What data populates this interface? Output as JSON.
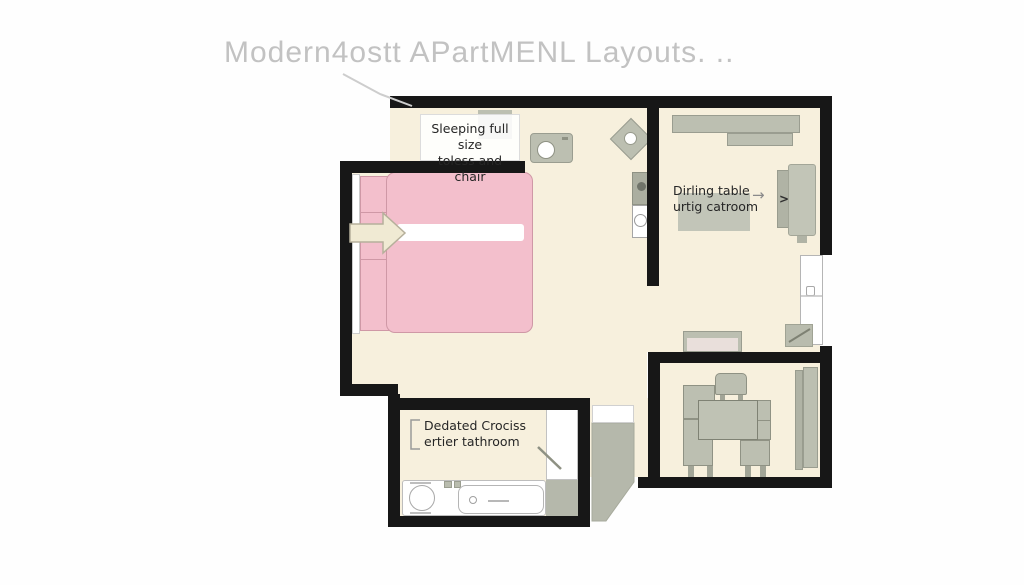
{
  "title": "Modern4ostt APartMENL Layouts. ..",
  "plan": {
    "sleeping_label": {
      "line1": "Sleeping full size",
      "line2": "toless and chair"
    },
    "dining_label": {
      "line1": "Dirling table",
      "line2": "urtig catroom"
    },
    "bathroom_label": {
      "line1": "Dedated Crociss",
      "line2": "ertier tathroom"
    },
    "dining_arrow_glyph": "→",
    "armchair_glyph": ">"
  },
  "colors": {
    "wall": "#171717",
    "floor": "#f7f0dd",
    "furniture_gray": "#bcbfb1",
    "furniture_border": "#9a9d90",
    "bed_pink": "#f3bfcc",
    "bed_border": "#cf98a6",
    "arrow_beige": "#f0ead3",
    "arrow_border": "#b6b09b",
    "title_gray": "#c2c2c2",
    "label_ink": "#262626",
    "hall_gray": "#b5b8ab"
  }
}
